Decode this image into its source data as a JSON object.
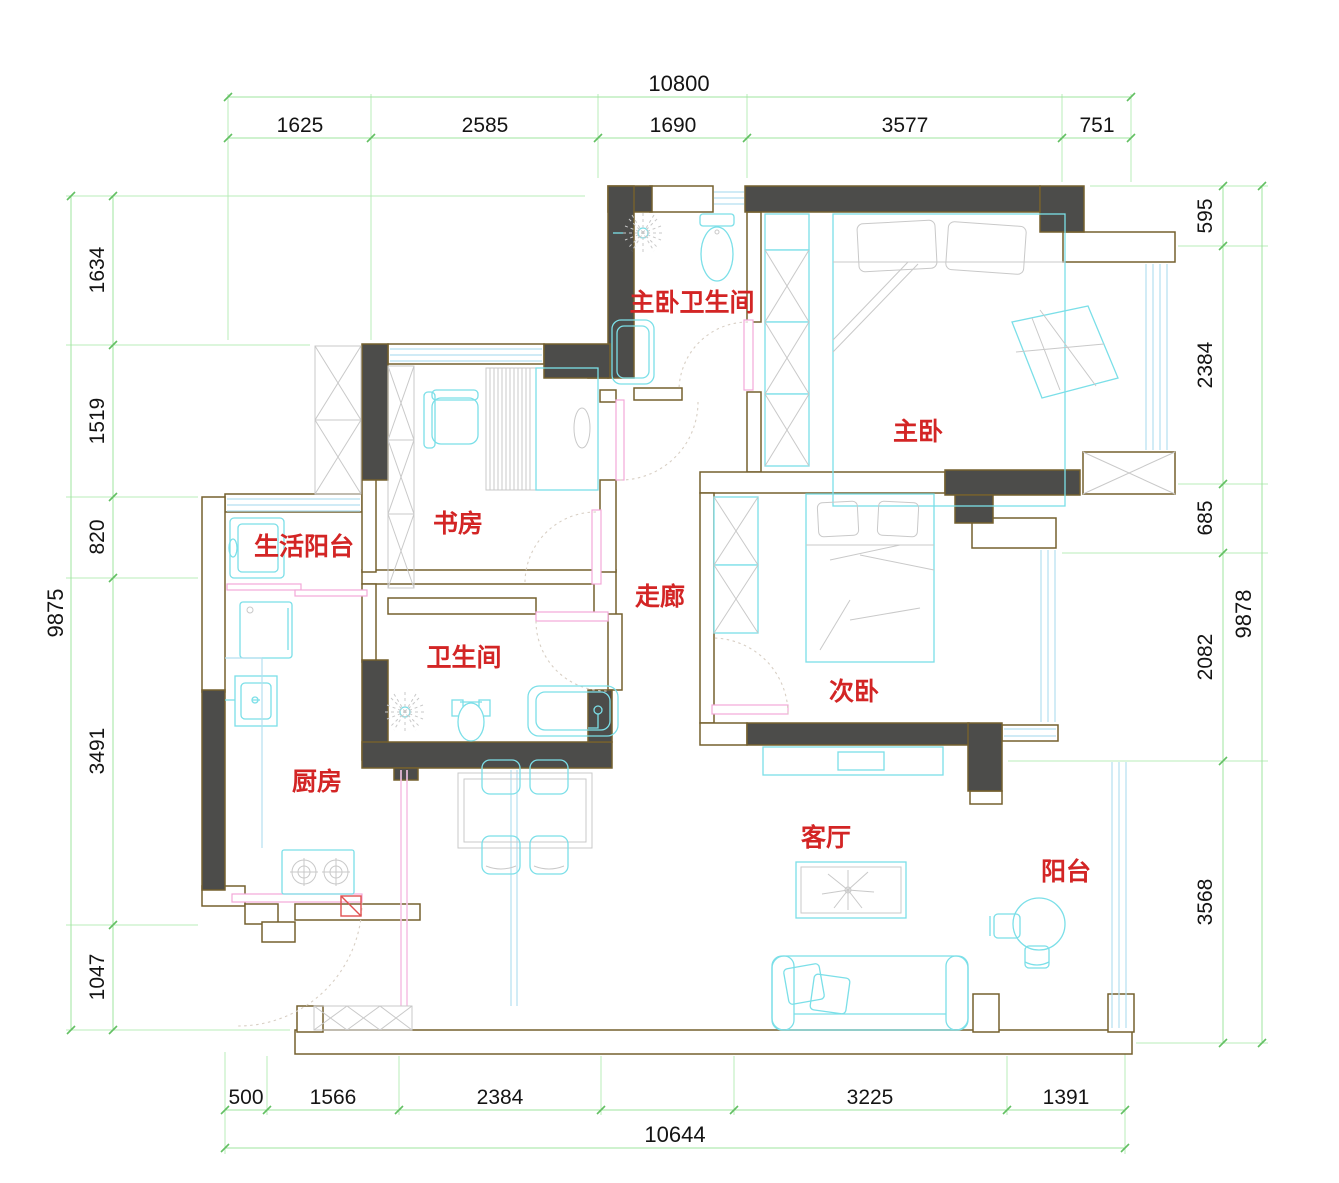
{
  "drawing_title": "apartment-floor-plan",
  "colors": {
    "wall_fill": "#4c4c4a",
    "wall_stroke": "#75602e",
    "furniture": "#7bdfe8",
    "window_glass": "#b5dff0",
    "dimension_line": "#9fe49f",
    "dimension_text": "#141414",
    "room_label": "#d32525",
    "door_leaf": "#f2a8d8"
  },
  "rooms": [
    {
      "id": "master-bathroom",
      "label": "主卧卫生间"
    },
    {
      "id": "master-bedroom",
      "label": "主卧"
    },
    {
      "id": "study",
      "label": "书房"
    },
    {
      "id": "service-balcony",
      "label": "生活阳台"
    },
    {
      "id": "corridor",
      "label": "走廊"
    },
    {
      "id": "bathroom",
      "label": "卫生间"
    },
    {
      "id": "second-bedroom",
      "label": "次卧"
    },
    {
      "id": "kitchen",
      "label": "厨房"
    },
    {
      "id": "living-room",
      "label": "客厅"
    },
    {
      "id": "balcony",
      "label": "阳台"
    }
  ],
  "dimensions": {
    "top": {
      "overall": "10800",
      "segments": [
        "1625",
        "2585",
        "1690",
        "3577",
        "751"
      ]
    },
    "left": {
      "overall": "9875",
      "segments": [
        "1634",
        "1519",
        "820",
        "3491",
        "1047"
      ]
    },
    "right": {
      "overall": "9878",
      "segments": [
        "595",
        "2384",
        "685",
        "2082",
        "3568"
      ]
    },
    "bottom": {
      "overall": "10644",
      "segments": [
        "500",
        "1566",
        "2384",
        "3225",
        "1391"
      ]
    }
  }
}
